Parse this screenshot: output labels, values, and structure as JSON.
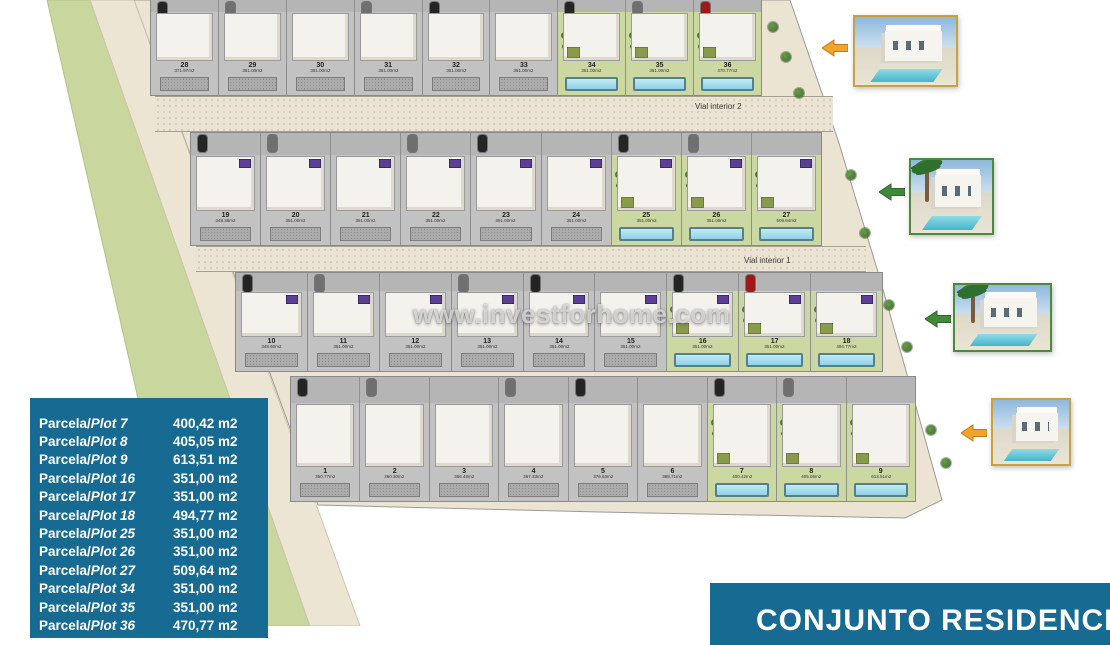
{
  "watermark": {
    "text": "www.investforhome.com"
  },
  "roads": {
    "vial1": "Vial interior 1",
    "vial2": "Vial interior 2"
  },
  "banner": {
    "text": "CONJUNTO RESIDENCIAL"
  },
  "colors": {
    "table_blue": "#176a92",
    "banner_blue": "#176a92",
    "highlight_green": "#ccd8a2",
    "pool_blue": "#8fd2e6",
    "band_green": "#c9d69e",
    "frame_gold": "#c9a23c",
    "frame_green": "#4c8a3c",
    "arrow_orange": "#f2a32a",
    "arrow_green": "#3f8a3a"
  },
  "site_plan": {
    "rows": [
      {
        "plots": [
          {
            "num": "28",
            "area": "371.97m2",
            "highlight": false
          },
          {
            "num": "29",
            "area": "351.00m2",
            "highlight": false
          },
          {
            "num": "30",
            "area": "351.00m2",
            "highlight": false
          },
          {
            "num": "31",
            "area": "351.00m2",
            "highlight": false
          },
          {
            "num": "32",
            "area": "351.00m2",
            "highlight": false
          },
          {
            "num": "33",
            "area": "351.00m2",
            "highlight": false
          },
          {
            "num": "34",
            "area": "351.00m2",
            "highlight": true
          },
          {
            "num": "35",
            "area": "351.00m2",
            "highlight": true
          },
          {
            "num": "36",
            "area": "470.77m2",
            "highlight": true
          }
        ]
      },
      {
        "plots": [
          {
            "num": "19",
            "area": "348.38m2",
            "highlight": false
          },
          {
            "num": "20",
            "area": "351.00m2",
            "highlight": false
          },
          {
            "num": "21",
            "area": "351.00m2",
            "highlight": false
          },
          {
            "num": "22",
            "area": "351.00m2",
            "highlight": false
          },
          {
            "num": "23",
            "area": "351.00m2",
            "highlight": false
          },
          {
            "num": "24",
            "area": "351.00m2",
            "highlight": false
          },
          {
            "num": "25",
            "area": "351.00m2",
            "highlight": true
          },
          {
            "num": "26",
            "area": "351.00m2",
            "highlight": true
          },
          {
            "num": "27",
            "area": "509.64m2",
            "highlight": true
          }
        ]
      },
      {
        "plots": [
          {
            "num": "10",
            "area": "348.60m2",
            "highlight": false
          },
          {
            "num": "11",
            "area": "351.00m2",
            "highlight": false
          },
          {
            "num": "12",
            "area": "351.00m2",
            "highlight": false
          },
          {
            "num": "13",
            "area": "351.00m2",
            "highlight": false
          },
          {
            "num": "14",
            "area": "351.00m2",
            "highlight": false
          },
          {
            "num": "15",
            "area": "351.00m2",
            "highlight": false
          },
          {
            "num": "16",
            "area": "351.00m2",
            "highlight": true
          },
          {
            "num": "17",
            "area": "351.00m2",
            "highlight": true
          },
          {
            "num": "18",
            "area": "494.77m2",
            "highlight": true
          }
        ]
      },
      {
        "plots": [
          {
            "num": "1",
            "area": "350.77m2",
            "highlight": false
          },
          {
            "num": "2",
            "area": "360.30m2",
            "highlight": false
          },
          {
            "num": "3",
            "area": "356.48m2",
            "highlight": false
          },
          {
            "num": "4",
            "area": "367.33m2",
            "highlight": false
          },
          {
            "num": "5",
            "area": "376.63m2",
            "highlight": false
          },
          {
            "num": "6",
            "area": "388.71m2",
            "highlight": false
          },
          {
            "num": "7",
            "area": "400.42m2",
            "highlight": true
          },
          {
            "num": "8",
            "area": "405.05m2",
            "highlight": true
          },
          {
            "num": "9",
            "area": "613.51m2",
            "highlight": true
          }
        ]
      }
    ]
  },
  "plot_table": {
    "rows": [
      {
        "label_regular": "Parcela/",
        "label_italic": "Plot 7",
        "area": "400,42 m2"
      },
      {
        "label_regular": "Parcela/",
        "label_italic": "Plot 8",
        "area": "405,05 m2"
      },
      {
        "label_regular": "Parcela/",
        "label_italic": "Plot 9",
        "area": "613,51 m2"
      },
      {
        "label_regular": "Parcela/",
        "label_italic": "Plot 16",
        "area": "351,00 m2"
      },
      {
        "label_regular": "Parcela/",
        "label_italic": "Plot 17",
        "area": "351,00 m2"
      },
      {
        "label_regular": "Parcela/",
        "label_italic": "Plot 18",
        "area": "494,77 m2"
      },
      {
        "label_regular": "Parcela/",
        "label_italic": "Plot 25",
        "area": "351,00 m2"
      },
      {
        "label_regular": "Parcela/",
        "label_italic": "Plot 26",
        "area": "351,00 m2"
      },
      {
        "label_regular": "Parcela/",
        "label_italic": "Plot 27",
        "area": "509,64 m2"
      },
      {
        "label_regular": "Parcela/",
        "label_italic": "Plot 34",
        "area": "351,00 m2"
      },
      {
        "label_regular": "Parcela/",
        "label_italic": "Plot 35",
        "area": "351,00 m2"
      },
      {
        "label_regular": "Parcela/",
        "label_italic": "Plot 36",
        "area": "470,77 m2"
      }
    ]
  },
  "photos": [
    {
      "name": "villa-render-top",
      "frame": "gold",
      "arrow": "orange"
    },
    {
      "name": "villa-render-middle-1",
      "frame": "green",
      "arrow": "green"
    },
    {
      "name": "villa-render-middle-2",
      "frame": "green",
      "arrow": "green"
    },
    {
      "name": "villa-render-bottom",
      "frame": "gold",
      "arrow": "orange"
    }
  ]
}
